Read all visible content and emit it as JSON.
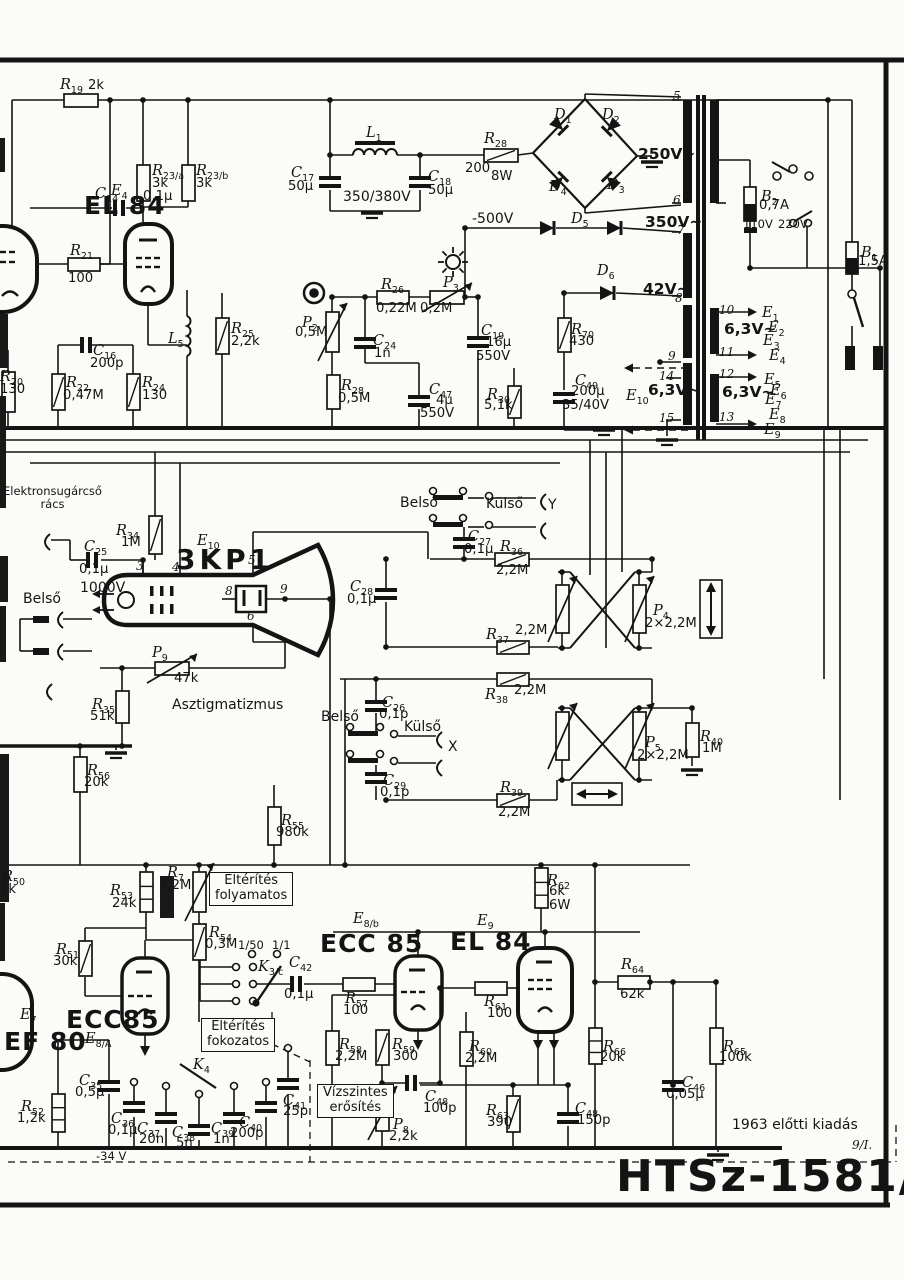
{
  "page": {
    "model": "HTSz-1581/S",
    "edition": "1963 előtti kiadás",
    "sheet": "9/I."
  },
  "texts": [
    {
      "id": "electron-gun-grid",
      "t": "Elektronsugárcső\nrács",
      "x": 3,
      "y": 485,
      "cls": "sm c"
    },
    {
      "id": "belso-1",
      "t": "Belső",
      "x": 23,
      "y": 592,
      "cls": "md"
    },
    {
      "id": "belso-2",
      "t": "Belső",
      "x": 400,
      "y": 496,
      "cls": "md"
    },
    {
      "id": "kulso-1",
      "t": "Külső",
      "x": 486,
      "y": 497,
      "cls": "md"
    },
    {
      "id": "y-label",
      "t": "Y",
      "x": 548,
      "y": 498,
      "cls": "md"
    },
    {
      "id": "belso-3",
      "t": "Belső",
      "x": 321,
      "y": 710,
      "cls": "md"
    },
    {
      "id": "kulso-2",
      "t": "Külső",
      "x": 404,
      "y": 720,
      "cls": "md"
    },
    {
      "id": "x-label",
      "t": "X",
      "x": 448,
      "y": 740,
      "cls": "md"
    },
    {
      "id": "astigmatism",
      "t": "Asztigmatizmus",
      "x": 172,
      "y": 698,
      "cls": "md"
    },
    {
      "id": "v-minus500",
      "t": "-500V",
      "x": 472,
      "y": 212,
      "cls": "md"
    },
    {
      "id": "v-350-380",
      "t": "350/380V",
      "x": 343,
      "y": 190,
      "cls": "md"
    },
    {
      "id": "v-250",
      "t": "250V~",
      "x": 638,
      "y": 146,
      "cls": "md2"
    },
    {
      "id": "v-350",
      "t": "350V~",
      "x": 645,
      "y": 214,
      "cls": "md2"
    },
    {
      "id": "v-42",
      "t": "42V~",
      "x": 643,
      "y": 281,
      "cls": "md2"
    },
    {
      "id": "v-63-a",
      "t": "6,3V~",
      "x": 724,
      "y": 321,
      "cls": "md2"
    },
    {
      "id": "v-63-b",
      "t": "6,3V~",
      "x": 648,
      "y": 382,
      "cls": "md2"
    },
    {
      "id": "v-63-c",
      "t": "6,3V~",
      "x": 722,
      "y": 384,
      "cls": "md2"
    },
    {
      "id": "v-110",
      "t": "110V",
      "x": 743,
      "y": 218,
      "cls": "sm"
    },
    {
      "id": "v-220",
      "t": "220V",
      "x": 778,
      "y": 218,
      "cls": "sm"
    },
    {
      "id": "v-1000",
      "t": "1000V",
      "x": 80,
      "y": 581,
      "cls": "md"
    },
    {
      "id": "term-5",
      "t": "5",
      "x": 673,
      "y": 90,
      "cls": "it"
    },
    {
      "id": "term-6",
      "t": "6",
      "x": 673,
      "y": 194,
      "cls": "it"
    },
    {
      "id": "term-7",
      "t": "7",
      "x": 677,
      "y": 224,
      "cls": "it"
    },
    {
      "id": "term-8",
      "t": "8",
      "x": 675,
      "y": 292,
      "cls": "it"
    },
    {
      "id": "term-9",
      "t": "9",
      "x": 668,
      "y": 350,
      "cls": "it"
    },
    {
      "id": "term-14",
      "t": "14",
      "x": 659,
      "y": 370,
      "cls": "it"
    },
    {
      "id": "term-15",
      "t": "15",
      "x": 659,
      "y": 412,
      "cls": "it"
    },
    {
      "id": "term-10",
      "t": "10",
      "x": 719,
      "y": 304,
      "cls": "it"
    },
    {
      "id": "term-11",
      "t": "11",
      "x": 719,
      "y": 346,
      "cls": "it"
    },
    {
      "id": "term-12",
      "t": "12",
      "x": 719,
      "y": 368,
      "cls": "it"
    },
    {
      "id": "term-13",
      "t": "13",
      "x": 719,
      "y": 411,
      "cls": "it"
    },
    {
      "id": "crt-pin-3",
      "t": "3",
      "x": 136,
      "y": 560,
      "cls": "it"
    },
    {
      "id": "crt-pin-4",
      "t": "4",
      "x": 172,
      "y": 561,
      "cls": "it"
    },
    {
      "id": "crt-pin-5",
      "t": "5",
      "x": 248,
      "y": 554,
      "cls": "it"
    },
    {
      "id": "crt-pin-8",
      "t": "8",
      "x": 225,
      "y": 585,
      "cls": "it"
    },
    {
      "id": "crt-pin-9",
      "t": "9",
      "x": 280,
      "y": 583,
      "cls": "it"
    },
    {
      "id": "crt-pin-6",
      "t": "6",
      "x": 247,
      "y": 610,
      "cls": "it"
    },
    {
      "id": "ratio-1-50",
      "t": "1/50",
      "x": 238,
      "y": 939,
      "cls": "sm"
    },
    {
      "id": "ratio-1-1",
      "t": "1/1",
      "x": 272,
      "y": 939,
      "cls": "sm"
    },
    {
      "id": "v-minus34",
      "t": "-34 V",
      "x": 96,
      "y": 1150,
      "cls": "sm"
    },
    {
      "id": "edition",
      "t": "1963 előtti kiadás",
      "x": 732,
      "y": 1118,
      "cls": "md"
    },
    {
      "id": "sheet-number",
      "t": "9/I.",
      "x": 852,
      "y": 1139,
      "cls": "it"
    },
    {
      "id": "model-number",
      "t": "HTSz-1581/S",
      "x": 616,
      "y": 1152,
      "cls": "huge"
    },
    {
      "id": "tube-el84-top",
      "t": "EL 84",
      "x": 84,
      "y": 192,
      "cls": "big"
    },
    {
      "id": "tube-3kp1",
      "t": "3KP1",
      "x": 176,
      "y": 544,
      "cls": "big2"
    },
    {
      "id": "tube-ecc85-left",
      "t": "ECC85",
      "x": 66,
      "y": 1006,
      "cls": "big"
    },
    {
      "id": "tube-ef80",
      "t": "EF 80",
      "x": 4,
      "y": 1028,
      "cls": "big"
    },
    {
      "id": "tube-ecc85-mid",
      "t": "ECC 85",
      "x": 320,
      "y": 930,
      "cls": "big"
    },
    {
      "id": "tube-el84-mid",
      "t": "EL 84",
      "x": 450,
      "y": 928,
      "cls": "big"
    },
    {
      "id": "box-deflection-continuous",
      "t": "Eltérítés\nfolyamatos",
      "x": 209,
      "y": 872,
      "cls": "boxed"
    },
    {
      "id": "box-deflection-stepped",
      "t": "Eltérítés\nfokozatos",
      "x": 201,
      "y": 1018,
      "cls": "boxed"
    },
    {
      "id": "box-horizontal-gain",
      "t": "Vízszintes\nerősítés",
      "x": 317,
      "y": 1084,
      "cls": "boxed"
    }
  ],
  "components": [
    {
      "id": "R19",
      "d": "R",
      "s": "19",
      "v": "2k",
      "x": 60,
      "y": 74
    },
    {
      "id": "C14",
      "d": "C",
      "s": "14",
      "v": "0,1μ",
      "x": 95,
      "y": 183,
      "vx": 143,
      "vy": 190
    },
    {
      "id": "E4",
      "d": "E",
      "s": "4",
      "v": "",
      "x": 111,
      "y": 180
    },
    {
      "id": "R23a",
      "d": "R",
      "s": "23/a",
      "v": "3k",
      "x": 152,
      "y": 160,
      "vx": 152,
      "vy": 177
    },
    {
      "id": "R23b",
      "d": "R",
      "s": "23/b",
      "v": "3k",
      "x": 196,
      "y": 160,
      "vx": 196,
      "vy": 177
    },
    {
      "id": "R21",
      "d": "R",
      "s": "21",
      "v": "100",
      "x": 70,
      "y": 240,
      "vx": 68,
      "vy": 272
    },
    {
      "id": "R20",
      "d": "R",
      "s": "20",
      "v": "130",
      "x": 0,
      "y": 366,
      "vx": 0,
      "vy": 383
    },
    {
      "id": "R22",
      "d": "R",
      "s": "22",
      "v": "0,47M",
      "x": 66,
      "y": 372,
      "vx": 63,
      "vy": 389
    },
    {
      "id": "C16",
      "d": "C",
      "s": "16",
      "v": "200p",
      "x": 93,
      "y": 340,
      "vx": 90,
      "vy": 357
    },
    {
      "id": "R24",
      "d": "R",
      "s": "24",
      "v": "130",
      "x": 142,
      "y": 372,
      "vx": 142,
      "vy": 389
    },
    {
      "id": "L5",
      "d": "L",
      "s": "5",
      "v": "",
      "x": 168,
      "y": 328
    },
    {
      "id": "R25",
      "d": "R",
      "s": "25",
      "v": "2,2k",
      "x": 231,
      "y": 318,
      "vx": 231,
      "vy": 335
    },
    {
      "id": "L1",
      "d": "L",
      "s": "1",
      "v": "",
      "x": 366,
      "y": 122
    },
    {
      "id": "C17",
      "d": "C",
      "s": "17",
      "v": "50μ",
      "x": 291,
      "y": 162,
      "vx": 288,
      "vy": 180
    },
    {
      "id": "C18",
      "d": "C",
      "s": "18",
      "v": "50μ",
      "x": 428,
      "y": 166,
      "vx": 428,
      "vy": 184
    },
    {
      "id": "R28a",
      "d": "R",
      "s": "28",
      "v": "200",
      "x": 484,
      "y": 128,
      "vx": 465,
      "vy": 162,
      "v2": "8W",
      "v2x": 491,
      "v2y": 170
    },
    {
      "id": "D1",
      "d": "D",
      "s": "1",
      "v": "",
      "x": 554,
      "y": 104
    },
    {
      "id": "D2",
      "d": "D",
      "s": "2",
      "v": "",
      "x": 602,
      "y": 104
    },
    {
      "id": "D3",
      "d": "D",
      "s": "3",
      "v": "",
      "x": 607,
      "y": 174
    },
    {
      "id": "D4",
      "d": "D",
      "s": "4",
      "v": "",
      "x": 549,
      "y": 176
    },
    {
      "id": "D5",
      "d": "D",
      "s": "5",
      "v": "",
      "x": 571,
      "y": 208
    },
    {
      "id": "D6",
      "d": "D",
      "s": "6",
      "v": "",
      "x": 597,
      "y": 260
    },
    {
      "id": "P2",
      "d": "P",
      "s": "2",
      "v": "0,5M",
      "x": 302,
      "y": 312,
      "vx": 295,
      "vy": 326
    },
    {
      "id": "R26",
      "d": "R",
      "s": "26",
      "v": "0,22M",
      "x": 381,
      "y": 274,
      "vx": 376,
      "vy": 302
    },
    {
      "id": "P3",
      "d": "P",
      "s": "3",
      "v": "0,2M",
      "x": 443,
      "y": 272,
      "vx": 420,
      "vy": 302
    },
    {
      "id": "C24",
      "d": "C",
      "s": "24",
      "v": "1n",
      "x": 373,
      "y": 330,
      "vx": 374,
      "vy": 347
    },
    {
      "id": "C19",
      "d": "C",
      "s": "19",
      "v": "16μ",
      "x": 481,
      "y": 320,
      "vx": 486,
      "vy": 336,
      "v2": "550V",
      "v2x": 476,
      "v2y": 350
    },
    {
      "id": "C47",
      "d": "C",
      "s": "47",
      "v": "4μ",
      "x": 429,
      "y": 379,
      "vx": 436,
      "vy": 394,
      "v2": "550V",
      "v2x": 420,
      "v2y": 407
    },
    {
      "id": "R28b",
      "d": "R",
      "s": "28",
      "v": "0,5M",
      "x": 341,
      "y": 375,
      "vx": 338,
      "vy": 392
    },
    {
      "id": "R30",
      "d": "R",
      "s": "30",
      "v": "5,1k",
      "x": 487,
      "y": 384,
      "vx": 484,
      "vy": 399
    },
    {
      "id": "R70",
      "d": "R",
      "s": "70",
      "v": "430",
      "x": 571,
      "y": 319,
      "vx": 569,
      "vy": 335
    },
    {
      "id": "C49",
      "d": "C",
      "s": "49",
      "v": "200μ",
      "x": 575,
      "y": 370,
      "vx": 571,
      "vy": 385,
      "v2": "35/40V",
      "v2x": 562,
      "v2y": 399
    },
    {
      "id": "B2",
      "d": "B",
      "s": "2",
      "v": "0,7A",
      "x": 761,
      "y": 186,
      "vx": 759,
      "vy": 199
    },
    {
      "id": "B1",
      "d": "B",
      "s": "1",
      "v": "1,5A",
      "x": 861,
      "y": 242,
      "vx": 858,
      "vy": 255
    },
    {
      "id": "E1h",
      "d": "E",
      "s": "1",
      "v": "",
      "x": 762,
      "y": 302
    },
    {
      "id": "E2h",
      "d": "E",
      "s": "2",
      "v": "",
      "x": 768,
      "y": 317
    },
    {
      "id": "E3h",
      "d": "E",
      "s": "3",
      "v": "",
      "x": 763,
      "y": 330
    },
    {
      "id": "E4h",
      "d": "E",
      "s": "4",
      "v": "",
      "x": 769,
      "y": 345
    },
    {
      "id": "E5h",
      "d": "E",
      "s": "5",
      "v": "",
      "x": 764,
      "y": 369
    },
    {
      "id": "E6h",
      "d": "E",
      "s": "6",
      "v": "",
      "x": 770,
      "y": 380
    },
    {
      "id": "E7h",
      "d": "E",
      "s": "7",
      "v": "",
      "x": 765,
      "y": 389
    },
    {
      "id": "E8h",
      "d": "E",
      "s": "8",
      "v": "",
      "x": 769,
      "y": 404
    },
    {
      "id": "E9h",
      "d": "E",
      "s": "9",
      "v": "",
      "x": 764,
      "y": 419
    },
    {
      "id": "E10t",
      "d": "E",
      "s": "10",
      "v": "",
      "x": 626,
      "y": 385
    },
    {
      "id": "C25",
      "d": "C",
      "s": "25",
      "v": "0,1μ",
      "x": 84,
      "y": 536,
      "vx": 79,
      "vy": 563
    },
    {
      "id": "R34",
      "d": "R",
      "s": "34",
      "v": "1M",
      "x": 116,
      "y": 520,
      "vx": 121,
      "vy": 536
    },
    {
      "id": "E10",
      "d": "E",
      "s": "10",
      "v": "",
      "x": 197,
      "y": 530
    },
    {
      "id": "C27",
      "d": "C",
      "s": "27",
      "v": "0,1μ",
      "x": 468,
      "y": 526,
      "vx": 464,
      "vy": 543
    },
    {
      "id": "R36",
      "d": "R",
      "s": "36",
      "v": "2,2M",
      "x": 500,
      "y": 536,
      "vx": 496,
      "vy": 564
    },
    {
      "id": "C28",
      "d": "C",
      "s": "28",
      "v": "0,1μ",
      "x": 350,
      "y": 576,
      "vx": 347,
      "vy": 593
    },
    {
      "id": "P4",
      "d": "P",
      "s": "4",
      "v": "2×2,2M",
      "x": 653,
      "y": 600,
      "vx": 645,
      "vy": 617
    },
    {
      "id": "R37",
      "d": "R",
      "s": "37",
      "v": "2,2M",
      "x": 486,
      "y": 624,
      "vx": 515,
      "vy": 624
    },
    {
      "id": "R38",
      "d": "R",
      "s": "38",
      "v": "2,2M",
      "x": 485,
      "y": 684,
      "vx": 514,
      "vy": 684
    },
    {
      "id": "P9",
      "d": "P",
      "s": "9",
      "v": "47k",
      "x": 152,
      "y": 642,
      "vx": 174,
      "vy": 672
    },
    {
      "id": "R35",
      "d": "R",
      "s": "35",
      "v": "51k",
      "x": 92,
      "y": 694,
      "vx": 90,
      "vy": 710
    },
    {
      "id": "C26",
      "d": "C",
      "s": "26",
      "v": "0,1p",
      "x": 382,
      "y": 692,
      "vx": 379,
      "vy": 708
    },
    {
      "id": "C29",
      "d": "C",
      "s": "29",
      "v": "0,1p",
      "x": 383,
      "y": 770,
      "vx": 380,
      "vy": 786
    },
    {
      "id": "R39",
      "d": "R",
      "s": "39",
      "v": "2,2M",
      "x": 500,
      "y": 777,
      "vx": 498,
      "vy": 806
    },
    {
      "id": "P5",
      "d": "P",
      "s": "5",
      "v": "2×2,2M",
      "x": 645,
      "y": 732,
      "vx": 637,
      "vy": 749
    },
    {
      "id": "R40",
      "d": "R",
      "s": "40",
      "v": "1M",
      "x": 700,
      "y": 726,
      "vx": 702,
      "vy": 742
    },
    {
      "id": "R56",
      "d": "R",
      "s": "56",
      "v": "20k",
      "x": 87,
      "y": 760,
      "vx": 84,
      "vy": 776
    },
    {
      "id": "R55",
      "d": "R",
      "s": "55",
      "v": "980k",
      "x": 281,
      "y": 810,
      "vx": 276,
      "vy": 826
    },
    {
      "id": "R50",
      "d": "R",
      "s": "50",
      "v": "2k",
      "x": 2,
      "y": 866,
      "vx": 0,
      "vy": 883
    },
    {
      "id": "R53",
      "d": "R",
      "s": "53",
      "v": "24k",
      "x": 110,
      "y": 880,
      "vx": 112,
      "vy": 897
    },
    {
      "id": "R7",
      "d": "R",
      "s": "7",
      "v": "2,2M",
      "x": 167,
      "y": 862,
      "vx": 159,
      "vy": 879
    },
    {
      "id": "R54",
      "d": "R",
      "s": "54",
      "v": "0,3M",
      "x": 209,
      "y": 922,
      "vx": 205,
      "vy": 938
    },
    {
      "id": "R51",
      "d": "R",
      "s": "51",
      "v": "30k",
      "x": 56,
      "y": 939,
      "vx": 53,
      "vy": 955
    },
    {
      "id": "E7",
      "d": "E",
      "s": "7",
      "v": "",
      "x": 20,
      "y": 1004
    },
    {
      "id": "E8A",
      "d": "E",
      "s": "8/A",
      "v": "",
      "x": 85,
      "y": 1028
    },
    {
      "id": "K3c",
      "d": "K",
      "s": "3/c",
      "v": "",
      "x": 258,
      "y": 956
    },
    {
      "id": "C42",
      "d": "C",
      "s": "42",
      "v": "0,1μ",
      "x": 289,
      "y": 952,
      "vx": 284,
      "vy": 988
    },
    {
      "id": "K4",
      "d": "K",
      "s": "4",
      "v": "",
      "x": 193,
      "y": 1054
    },
    {
      "id": "E8b",
      "d": "E",
      "s": "8/b",
      "v": "",
      "x": 353,
      "y": 908
    },
    {
      "id": "E9",
      "d": "E",
      "s": "9",
      "v": "",
      "x": 477,
      "y": 910
    },
    {
      "id": "R57",
      "d": "R",
      "s": "57",
      "v": "100",
      "x": 345,
      "y": 988,
      "vx": 343,
      "vy": 1004
    },
    {
      "id": "R61",
      "d": "R",
      "s": "61",
      "v": "100",
      "x": 484,
      "y": 991,
      "vx": 487,
      "vy": 1007
    },
    {
      "id": "R58",
      "d": "R",
      "s": "58",
      "v": "2,2M",
      "x": 339,
      "y": 1034,
      "vx": 335,
      "vy": 1050
    },
    {
      "id": "R59",
      "d": "R",
      "s": "59",
      "v": "300",
      "x": 392,
      "y": 1034,
      "vx": 393,
      "vy": 1050
    },
    {
      "id": "R60",
      "d": "R",
      "s": "60",
      "v": "2,2M",
      "x": 469,
      "y": 1036,
      "vx": 465,
      "vy": 1052
    },
    {
      "id": "R62",
      "d": "R",
      "s": "62",
      "v": "6k",
      "x": 547,
      "y": 870,
      "vx": 549,
      "vy": 885,
      "v2": "6W",
      "v2x": 549,
      "v2y": 899
    },
    {
      "id": "R64",
      "d": "R",
      "s": "64",
      "v": "62k",
      "x": 621,
      "y": 954,
      "vx": 620,
      "vy": 988
    },
    {
      "id": "R66",
      "d": "R",
      "s": "66",
      "v": "20k",
      "x": 603,
      "y": 1036,
      "vx": 600,
      "vy": 1051
    },
    {
      "id": "R65",
      "d": "R",
      "s": "65",
      "v": "100k",
      "x": 723,
      "y": 1036,
      "vx": 719,
      "vy": 1051
    },
    {
      "id": "C46",
      "d": "C",
      "s": "46",
      "v": "0,05μ",
      "x": 682,
      "y": 1072,
      "vx": 666,
      "vy": 1088
    },
    {
      "id": "C48a",
      "d": "C",
      "s": "48",
      "v": "100p",
      "x": 425,
      "y": 1086,
      "vx": 423,
      "vy": 1102
    },
    {
      "id": "C48b",
      "d": "C",
      "s": "48",
      "v": "150p",
      "x": 575,
      "y": 1098,
      "vx": 577,
      "vy": 1114
    },
    {
      "id": "P8",
      "d": "P",
      "s": "8",
      "v": "2,2k",
      "x": 393,
      "y": 1114,
      "vx": 389,
      "vy": 1130
    },
    {
      "id": "R63",
      "d": "R",
      "s": "63",
      "v": "390",
      "x": 486,
      "y": 1100,
      "vx": 487,
      "vy": 1116
    },
    {
      "id": "R52",
      "d": "R",
      "s": "52",
      "v": "1,2k",
      "x": 21,
      "y": 1096,
      "vx": 17,
      "vy": 1112
    },
    {
      "id": "C35",
      "d": "C",
      "s": "35",
      "v": "0,5μ",
      "x": 79,
      "y": 1070,
      "vx": 75,
      "vy": 1086
    },
    {
      "id": "C36",
      "d": "C",
      "s": "36",
      "v": "0,1μ",
      "x": 111,
      "y": 1108,
      "vx": 108,
      "vy": 1124
    },
    {
      "id": "C37",
      "d": "C",
      "s": "37",
      "v": "20n",
      "x": 137,
      "y": 1118,
      "vx": 139,
      "vy": 1133
    },
    {
      "id": "C38",
      "d": "C",
      "s": "38",
      "v": "5n",
      "x": 172,
      "y": 1122,
      "vx": 176,
      "vy": 1137
    },
    {
      "id": "C39",
      "d": "C",
      "s": "39",
      "v": "1n",
      "x": 211,
      "y": 1118,
      "vx": 213,
      "vy": 1133
    },
    {
      "id": "C40",
      "d": "C",
      "s": "40",
      "v": "200p",
      "x": 239,
      "y": 1112,
      "vx": 230,
      "vy": 1127
    },
    {
      "id": "C41",
      "d": "C",
      "s": "41",
      "v": "25p",
      "x": 283,
      "y": 1090,
      "vx": 283,
      "vy": 1105
    }
  ]
}
